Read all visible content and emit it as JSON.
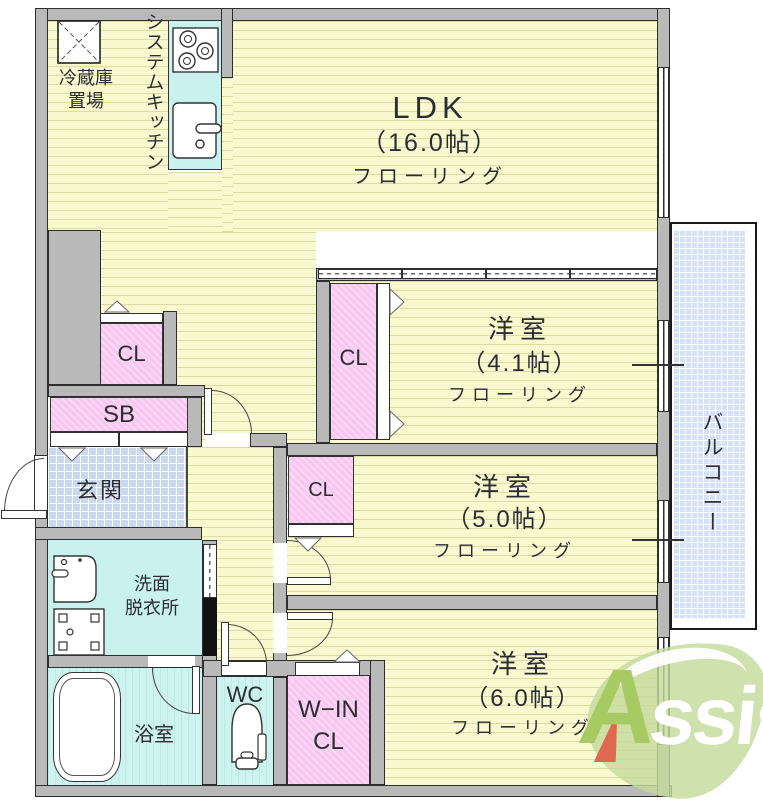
{
  "rooms": {
    "ldk": {
      "name": "LDK",
      "size": "（16.0帖）",
      "flooring": "フローリング"
    },
    "bedroom_41": {
      "name": "洋室",
      "size": "（4.1帖）",
      "flooring": "フローリング"
    },
    "bedroom_50": {
      "name": "洋室",
      "size": "（5.0帖）",
      "flooring": "フローリング"
    },
    "bedroom_60": {
      "name": "洋室",
      "size": "（6.0帖）",
      "flooring": "フローリング"
    },
    "entrance": "玄関",
    "washroom_line1": "洗面",
    "washroom_line2": "脱衣所",
    "bathroom": "浴室",
    "toilet": "WC",
    "balcony": "バルコニー",
    "system_kitchen": "システムキッチン",
    "fridge_line1": "冷蔵庫",
    "fridge_line2": "置場"
  },
  "storage": {
    "closet_ldk": "CL",
    "closet_41": "CL",
    "closet_50": "CL",
    "shoe_box": "SB",
    "walkin_line1": "W−IN",
    "walkin_line2": "CL"
  },
  "logo": {
    "initial": "A",
    "rest": "ssist"
  },
  "colors": {
    "floor_yellow": "#f9f9cf",
    "closet_pink": "#f8c8f0",
    "wet_cyan": "#c9f2ee",
    "tile_blue": "#c8d9f0",
    "wall_gray": "#b9b9b9",
    "logo_green": "#c5db9b",
    "logo_red": "#e06752"
  }
}
